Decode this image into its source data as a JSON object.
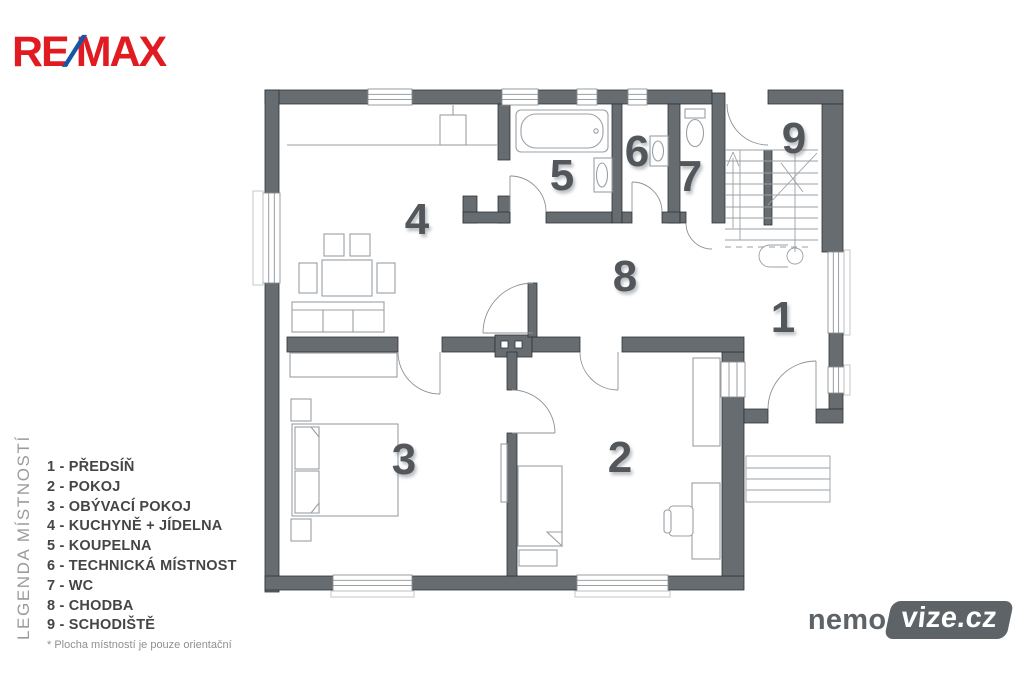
{
  "branding": {
    "remax": {
      "part1": "RE",
      "slash": "/",
      "part2": "MAX",
      "red": "#e01b22",
      "blue": "#1458a5"
    },
    "watermark": {
      "prefix": "nemo",
      "badge": "vize.cz",
      "gray": "#5d6367"
    }
  },
  "legend": {
    "vertical_title": "LEGENDA MÍSTNOSTÍ",
    "separator": " - ",
    "items": [
      {
        "num": "1",
        "name": "PŘEDSÍŇ"
      },
      {
        "num": "2",
        "name": "POKOJ"
      },
      {
        "num": "3",
        "name": "OBÝVACÍ POKOJ"
      },
      {
        "num": "4",
        "name": "KUCHYNĚ + JÍDELNA"
      },
      {
        "num": "5",
        "name": "KOUPELNA"
      },
      {
        "num": "6",
        "name": "TECHNICKÁ MÍSTNOST"
      },
      {
        "num": "7",
        "name": "WC"
      },
      {
        "num": "8",
        "name": "CHODBA"
      },
      {
        "num": "9",
        "name": "SCHODIŠTĚ"
      }
    ],
    "footnote": "* Plocha místností je pouze orientační"
  },
  "floorplan": {
    "room_numbers": [
      {
        "label": "1",
        "x": 783,
        "y": 318
      },
      {
        "label": "2",
        "x": 620,
        "y": 458
      },
      {
        "label": "3",
        "x": 404,
        "y": 460
      },
      {
        "label": "4",
        "x": 417,
        "y": 220
      },
      {
        "label": "5",
        "x": 562,
        "y": 176
      },
      {
        "label": "6",
        "x": 637,
        "y": 152
      },
      {
        "label": "7",
        "x": 690,
        "y": 177
      },
      {
        "label": "8",
        "x": 625,
        "y": 277
      },
      {
        "label": "9",
        "x": 794,
        "y": 139
      }
    ],
    "colors": {
      "wall": "#676c70",
      "wall_edge": "#2f3437",
      "furniture_line": "#9aa0a4",
      "window_line": "#8d9296",
      "room_number": "#53575b"
    }
  }
}
